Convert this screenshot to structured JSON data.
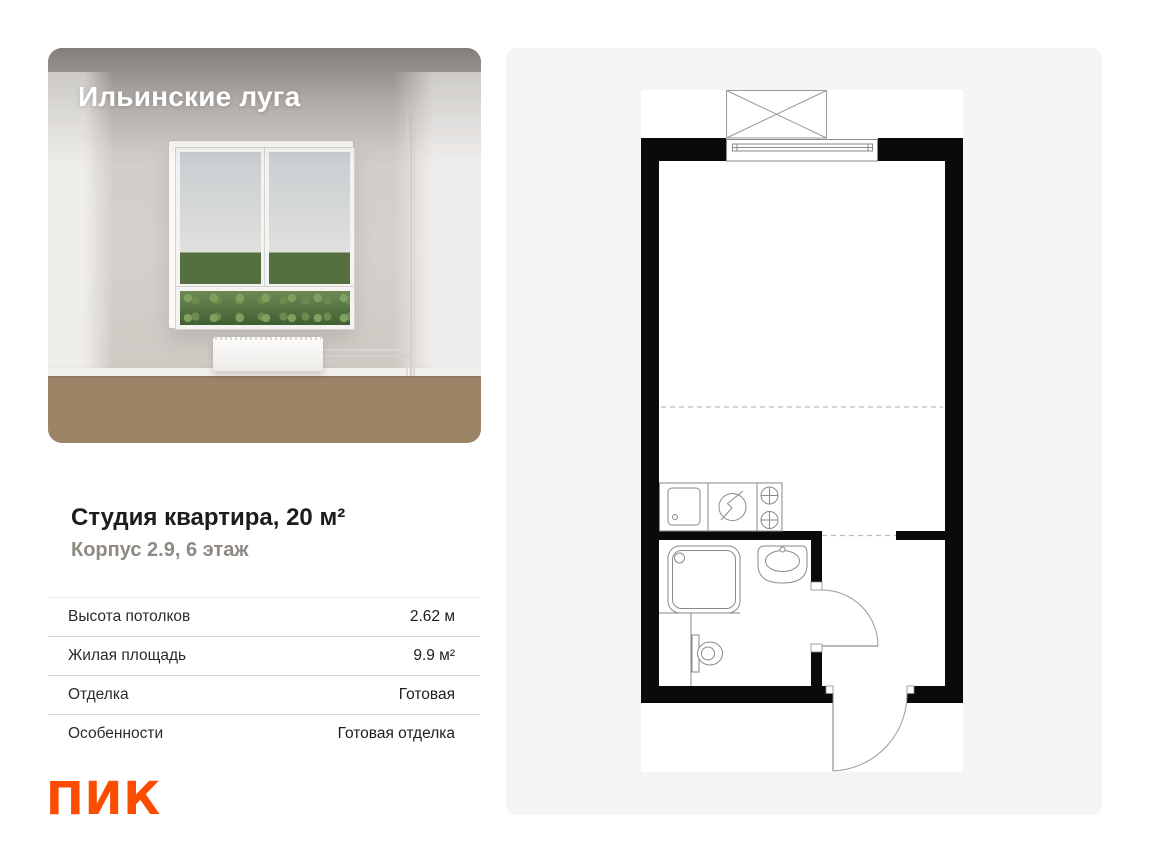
{
  "listing": {
    "project_name": "Ильинские луга",
    "title": "Студия квартира, 20 м²",
    "subtitle": "Корпус 2.9, 6 этаж",
    "specs": [
      {
        "label": "Высота потолков",
        "value": "2.62 м"
      },
      {
        "label": "Жилая площадь",
        "value": "9.9 м²"
      },
      {
        "label": "Отделка",
        "value": "Готовая"
      },
      {
        "label": "Особенности",
        "value": "Готовая отделка"
      }
    ],
    "developer_logo": "ПИК"
  },
  "colors": {
    "brand_orange": "#FC4C02",
    "panel_background": "#f5f5f3",
    "wall_black": "#0a0a0a"
  }
}
